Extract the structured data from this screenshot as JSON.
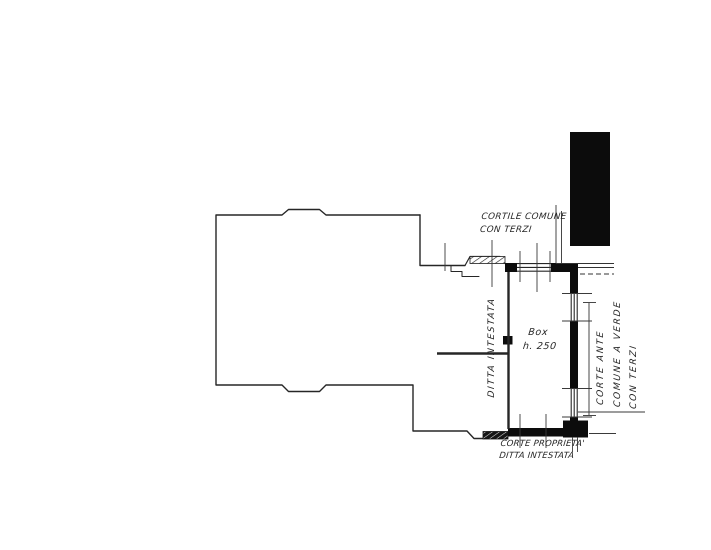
{
  "colors": {
    "paper": "#ffffff",
    "ink": "#262626",
    "wall": "#0c0c0c"
  },
  "labels": {
    "cortile_comune": {
      "line1": "CORTILE COMUNE",
      "line2": "CON TERZI"
    },
    "box": {
      "name": "Box",
      "height": "h. 250"
    },
    "ditta": "DITTA INTESTATA",
    "corte_ante": {
      "line1": "CORTE ANTE",
      "line2": "COMUNE A VERDE",
      "line3": "CON TERZI"
    },
    "corte_proprieta": {
      "line1": "CORTE PROPRIETA'",
      "line2": "DITTA INTESTATA"
    }
  }
}
